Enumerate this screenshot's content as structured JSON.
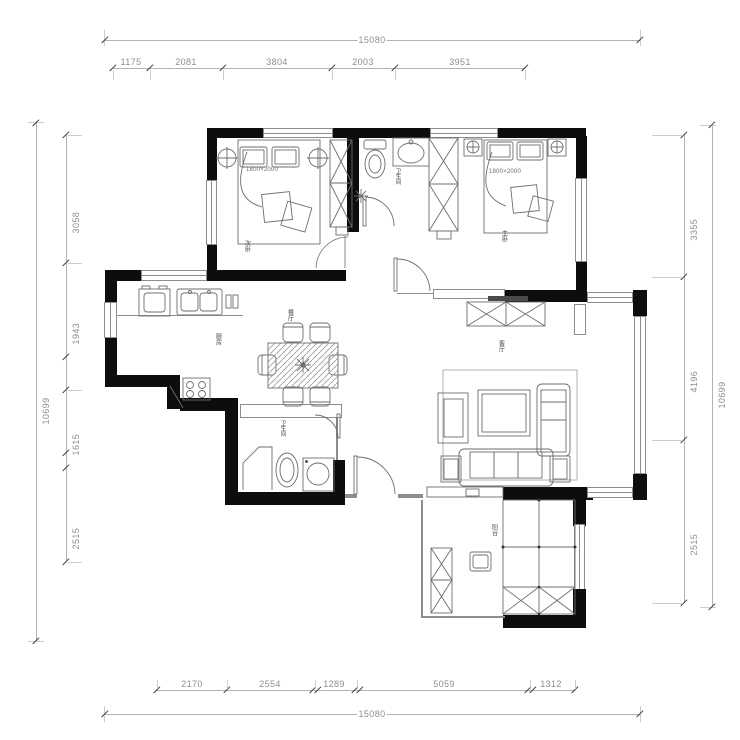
{
  "drawing": {
    "type": "residential floor plan",
    "bed_size_label": "1800×2000"
  },
  "rooms": {
    "bedroom_left": "次卧",
    "bedroom_right": "主卧",
    "bathroom": "卫生间",
    "kitchen": "厨房",
    "dining": "餐厅",
    "guest_bathroom": "卫生间",
    "living": "客厅",
    "balcony": "阳台"
  },
  "dimensions": {
    "top": {
      "total": "15080",
      "segments": [
        "1175",
        "2081",
        "3804",
        "2003",
        "3951"
      ]
    },
    "bottom": {
      "total": "15080",
      "segments": [
        "2170",
        "2554",
        "1289",
        "5059",
        "1312"
      ]
    },
    "left": {
      "total": "10699",
      "segments": [
        "3058",
        "1943",
        "1615",
        "2515"
      ]
    },
    "right": {
      "total": "10699",
      "segments": [
        "3355",
        "4196",
        "2515"
      ]
    }
  },
  "colors": {
    "wall": "#0d0d0d",
    "furniture_line": "#6e6e6e",
    "dimension_line": "#b3b3b3",
    "dimension_text": "#8e8e8e"
  }
}
